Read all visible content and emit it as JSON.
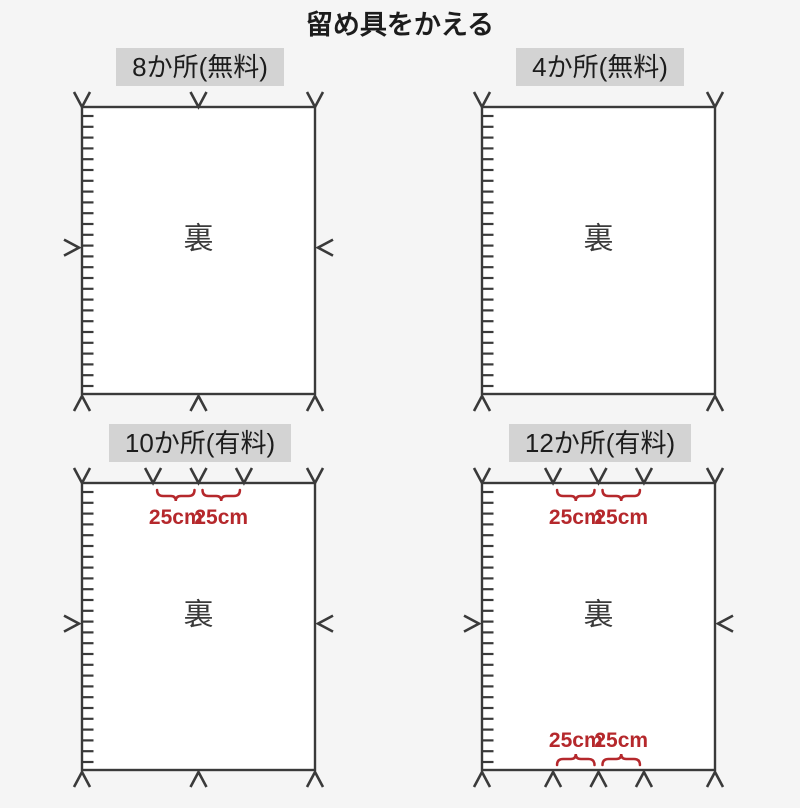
{
  "page": {
    "title": "留め具をかえる",
    "background": "#f5f5f5"
  },
  "colors": {
    "line": "#3a3a3a",
    "accent_red": "#b5282c",
    "header_bg": "#d3d3d3",
    "panel_bg": "#ffffff",
    "text": "#1c1c1c"
  },
  "labels": {
    "back": "裏",
    "dimension": "25cm"
  },
  "panels": [
    {
      "title": "8か所(無料)",
      "fastener_count": 8,
      "fee": "無料",
      "top_positions": [
        0,
        0.5,
        1
      ],
      "bottom_positions": [
        0,
        0.5,
        1
      ],
      "side_arrows": true,
      "top_dims": false,
      "bottom_dims": false
    },
    {
      "title": "4か所(無料)",
      "fastener_count": 4,
      "fee": "無料",
      "top_positions": [
        0,
        1
      ],
      "bottom_positions": [
        0,
        1
      ],
      "side_arrows": false,
      "top_dims": false,
      "bottom_dims": false
    },
    {
      "title": "10か所(有料)",
      "fastener_count": 10,
      "fee": "有料",
      "top_positions": [
        0,
        0.305,
        0.5,
        0.695,
        1
      ],
      "bottom_positions": [
        0,
        0.5,
        1
      ],
      "side_arrows": true,
      "top_dims": true,
      "bottom_dims": false
    },
    {
      "title": "12か所(有料)",
      "fastener_count": 12,
      "fee": "有料",
      "top_positions": [
        0,
        0.305,
        0.5,
        0.695,
        1
      ],
      "bottom_positions": [
        0,
        0.305,
        0.5,
        0.695,
        1
      ],
      "side_arrows": true,
      "top_dims": true,
      "bottom_dims": true
    }
  ]
}
